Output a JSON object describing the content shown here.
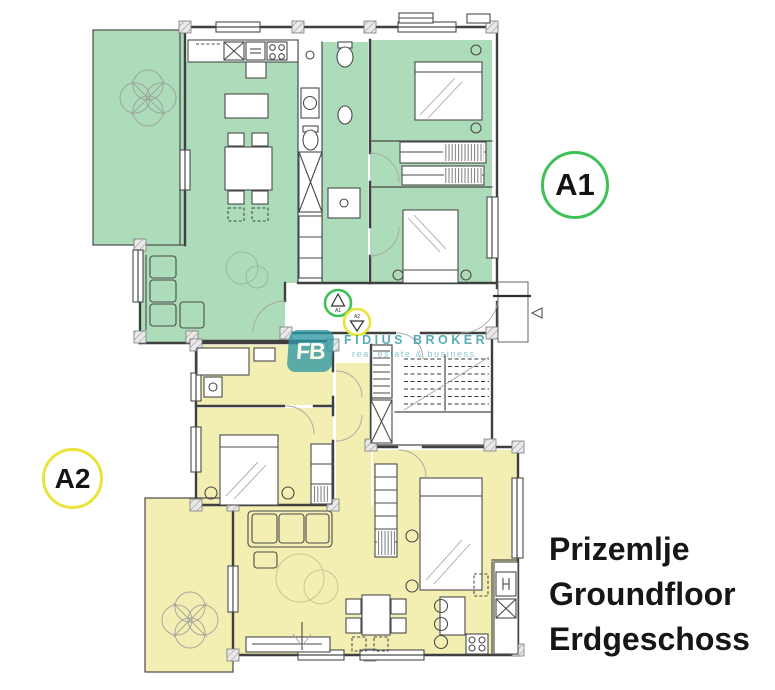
{
  "plan": {
    "colors": {
      "a1_fill": "#acdcb9",
      "a2_fill": "#f3efb2",
      "a1_ring": "#3ec157",
      "a2_ring": "#e9e43b",
      "wall": "#3f3f3f",
      "brand_teal": "#2e98a4"
    }
  },
  "badges": {
    "a1": {
      "label": "A1"
    },
    "a2": {
      "label": "A2"
    }
  },
  "entrance_markers": {
    "a1": {
      "label": "A1"
    },
    "a2": {
      "label": "A2"
    }
  },
  "watermark": {
    "monogram": "FB",
    "brand": "FIDIUS BROKER",
    "tagline": "real estate & business"
  },
  "floor_title": {
    "line1": "Prizemlje",
    "line2": "Groundfloor",
    "line3": "Erdgeschoss"
  }
}
